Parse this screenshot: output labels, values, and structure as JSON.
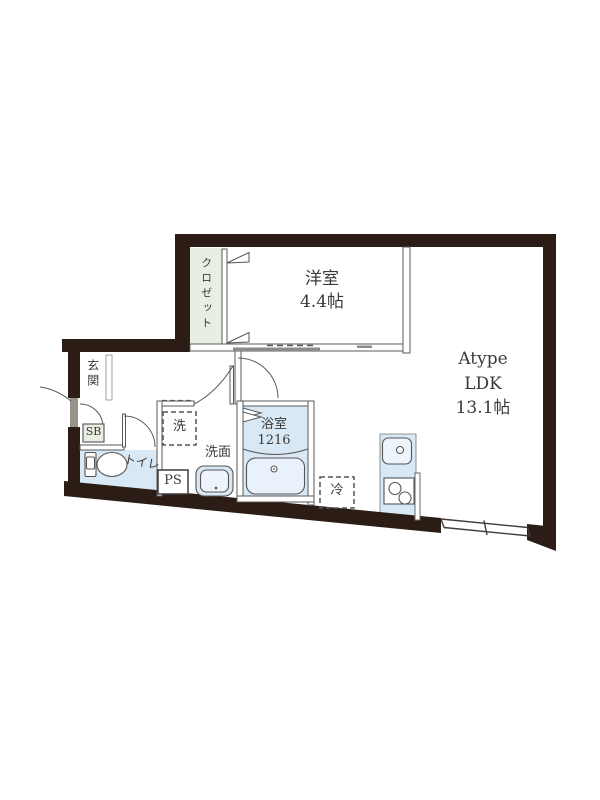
{
  "rooms": {
    "closet": {
      "label": "クロゼット"
    },
    "western_room": {
      "label": "洋室",
      "size": "4.4帖"
    },
    "ldk": {
      "line1": "Atype",
      "line2": "LDK",
      "line3": "13.1帖"
    },
    "entrance": {
      "label": "玄関"
    },
    "shoe_box": {
      "label": "SB"
    },
    "toilet": {
      "label": "トイレ"
    },
    "washing_machine": {
      "label": "洗"
    },
    "washroom": {
      "label": "洗面"
    },
    "pipe_space": {
      "label": "PS"
    },
    "bathroom": {
      "label": "浴室",
      "size": "1216"
    },
    "refrigerator": {
      "label": "冷"
    }
  },
  "colors": {
    "wall": "#2b1d15",
    "closet_fill": "#e8efe2",
    "water_area_fill": "#d8e8f5",
    "fixture_fill": "#edf4fb",
    "line": "#555555",
    "door_leaf": "#98938a"
  }
}
